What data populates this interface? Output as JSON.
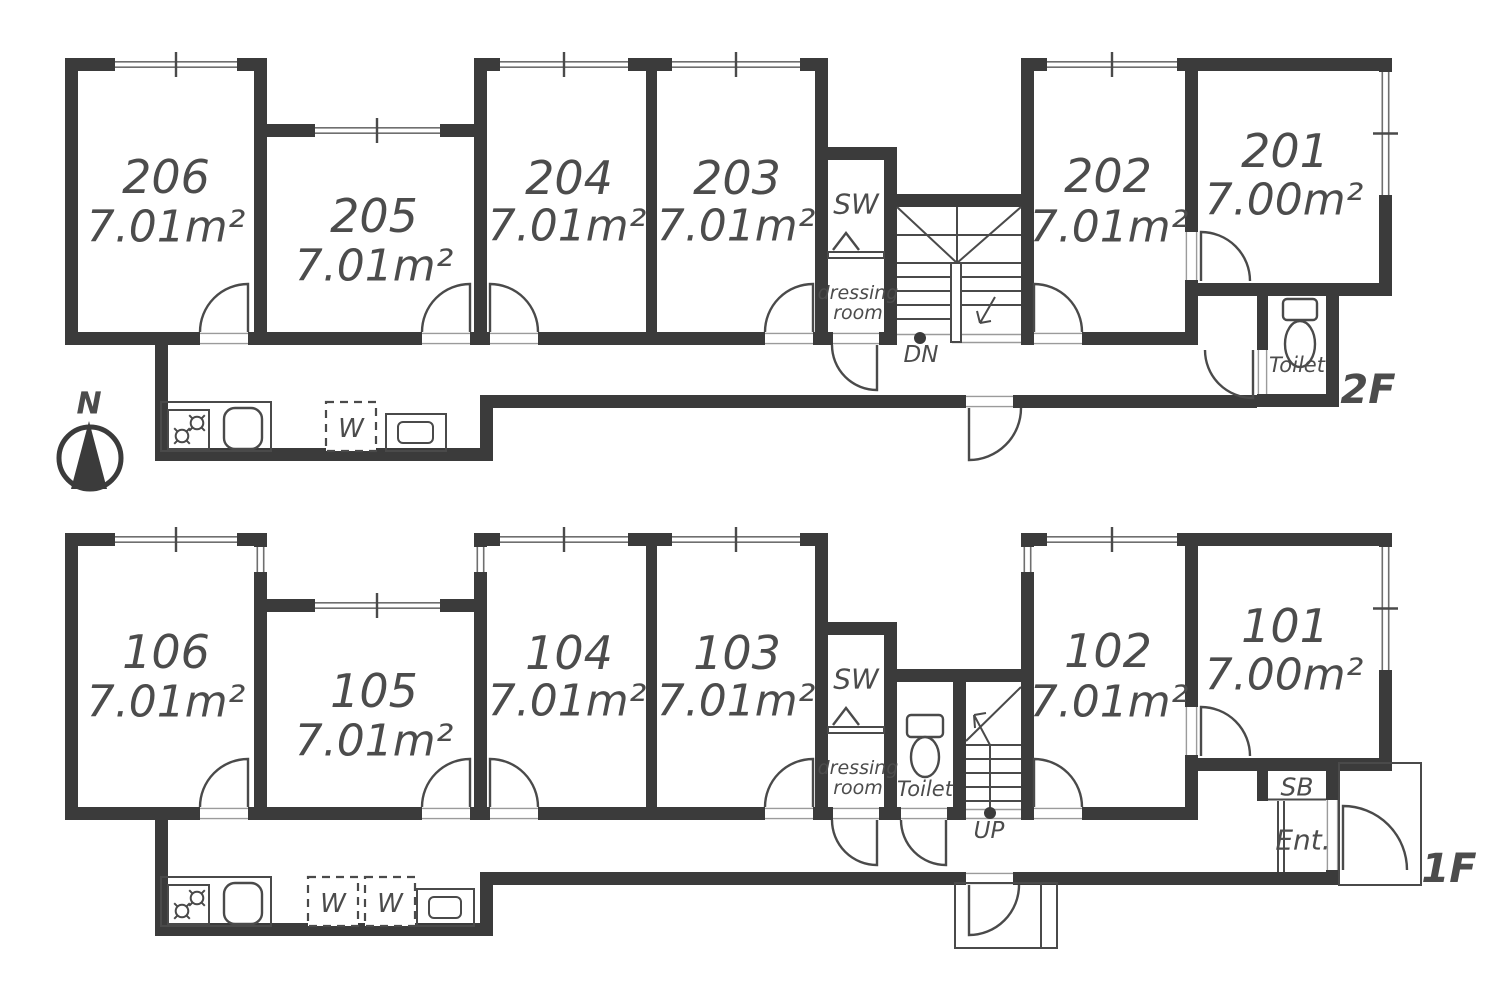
{
  "compass": {
    "label": "N"
  },
  "floor2": {
    "floor_label": "2F",
    "rooms": [
      {
        "number": "206",
        "area": "7.01m²"
      },
      {
        "number": "205",
        "area": "7.01m²"
      },
      {
        "number": "204",
        "area": "7.01m²"
      },
      {
        "number": "203",
        "area": "7.01m²"
      },
      {
        "number": "202",
        "area": "7.01m²"
      },
      {
        "number": "201",
        "area": "7.00m²"
      }
    ],
    "closet_label": "SW",
    "dressing_room_line1": "dressing",
    "dressing_room_line2": "room",
    "stair_label": "DN",
    "toilet_label": "Toilet",
    "washer_label": "W"
  },
  "floor1": {
    "floor_label": "1F",
    "rooms": [
      {
        "number": "106",
        "area": "7.01m²"
      },
      {
        "number": "105",
        "area": "7.01m²"
      },
      {
        "number": "104",
        "area": "7.01m²"
      },
      {
        "number": "103",
        "area": "7.01m²"
      },
      {
        "number": "102",
        "area": "7.01m²"
      },
      {
        "number": "101",
        "area": "7.00m²"
      }
    ],
    "closet_label": "SW",
    "dressing_room_line1": "dressing",
    "dressing_room_line2": "room",
    "stair_label": "UP",
    "toilet_label": "Toilet",
    "shoe_box_label": "SB",
    "entrance_label": "Ent.",
    "washer_label": "W"
  },
  "colors": {
    "wall": "#3b3b3b",
    "line": "#4a4a4a",
    "text": "#4c4c4c",
    "background": "#ffffff"
  }
}
